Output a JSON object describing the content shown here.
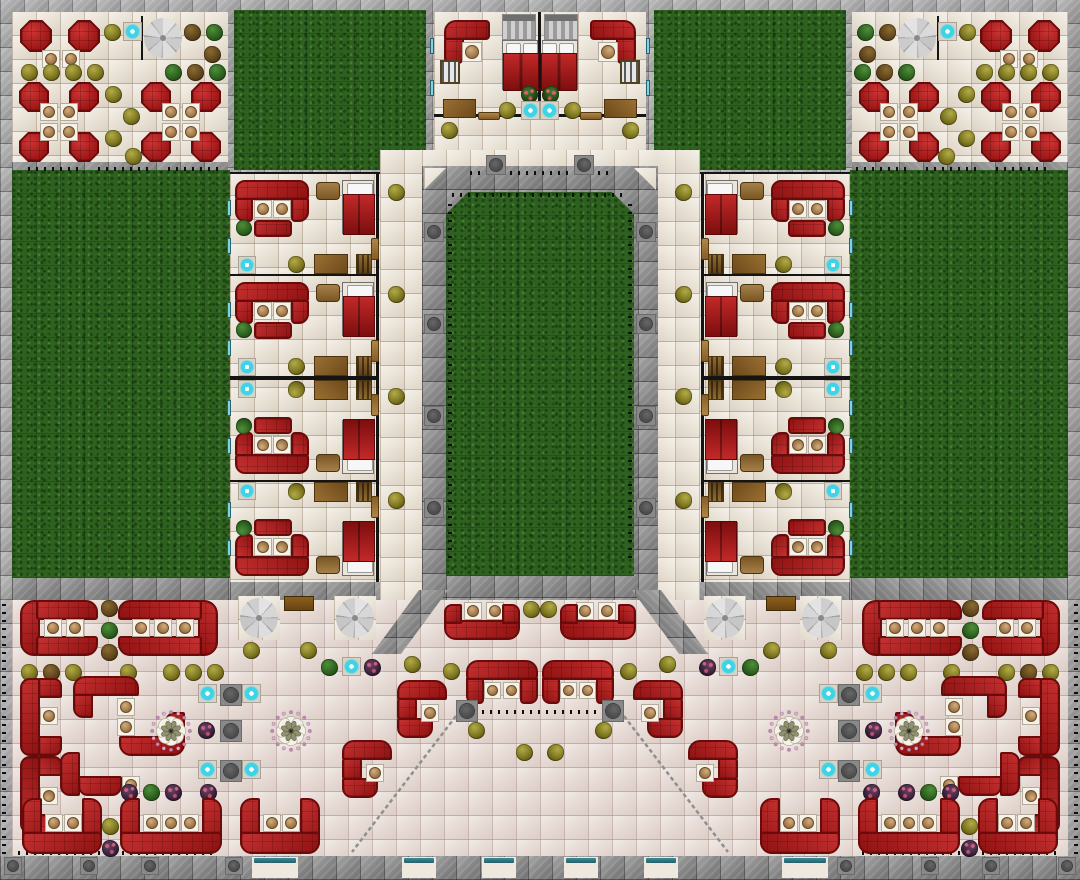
{
  "map": {
    "width": 1080,
    "height": 880,
    "tile": 24,
    "colors": {
      "sofa_red": "#a81c1c",
      "sofa_border": "#6a0b0b",
      "grass_green": "#2e6120",
      "floor_cream": "#eae3d7",
      "hall_floor": "#e7dbd5",
      "wall_gray": "#a4a4a4",
      "wall_dark": "#8d8d8d",
      "water_cyan": "#3cd4e6",
      "wood_brown": "#8a6028",
      "bench_teal": "#2e7682",
      "table_top": "#b08a58"
    },
    "regions": [
      {
        "c": "floor",
        "x": 12,
        "y": 12,
        "w": 216,
        "h": 150,
        "m": 1
      },
      {
        "c": "grass",
        "x": 234,
        "y": 10,
        "w": 192,
        "h": 160,
        "m": 1
      },
      {
        "c": "floor",
        "x": 434,
        "y": 12,
        "w": 212,
        "h": 103,
        "m": 0
      },
      {
        "c": "floor",
        "x": 434,
        "y": 112,
        "w": 212,
        "h": 40,
        "m": 0
      },
      {
        "c": "floor",
        "x": 422,
        "y": 150,
        "w": 236,
        "h": 18,
        "m": 0
      },
      {
        "c": "floor",
        "x": 380,
        "y": 150,
        "w": 42,
        "h": 452,
        "m": 1
      },
      {
        "c": "floor",
        "x": 230,
        "y": 172,
        "w": 150,
        "h": 410,
        "m": 1
      },
      {
        "c": "grass",
        "x": 12,
        "y": 170,
        "w": 218,
        "h": 408,
        "m": 1
      },
      {
        "c": "hall",
        "x": 12,
        "y": 600,
        "w": 1056,
        "h": 256,
        "m": 0
      },
      {
        "c": "walld",
        "x": 422,
        "y": 166,
        "w": 236,
        "h": 434,
        "m": 0
      },
      {
        "c": "walld",
        "x": 12,
        "y": 578,
        "w": 218,
        "h": 22,
        "m": 1
      },
      {
        "c": "walld",
        "x": 230,
        "y": 582,
        "w": 150,
        "h": 18,
        "m": 1
      },
      {
        "c": "walld",
        "x": 12,
        "y": 162,
        "w": 216,
        "h": 8,
        "m": 1
      },
      {
        "c": "walld",
        "x": 0,
        "y": 856,
        "w": 1080,
        "h": 24,
        "m": 0
      },
      {
        "c": "floor",
        "x": 238,
        "y": 596,
        "w": 42,
        "h": 44,
        "m": 1
      },
      {
        "c": "floor",
        "x": 334,
        "y": 596,
        "w": 42,
        "h": 44,
        "m": 1
      },
      {
        "c": "court",
        "x": 446,
        "y": 192,
        "w": 188,
        "h": 384,
        "m": 0
      },
      {
        "c": "ftril",
        "x": 424,
        "y": 168,
        "w": 22,
        "h": 22,
        "m": 0
      },
      {
        "c": "ftrir",
        "x": 634,
        "y": 168,
        "w": 22,
        "h": 22,
        "m": 0
      },
      {
        "c": "wedge",
        "x": 372,
        "y": 590,
        "w": 76,
        "h": 64,
        "m": 1
      }
    ],
    "walls": [
      {
        "x": 141,
        "y": 16,
        "w": 2,
        "h": 44,
        "m": 1
      },
      {
        "x": 538,
        "y": 12,
        "w": 3,
        "h": 104,
        "m": 0
      },
      {
        "x": 434,
        "y": 114,
        "w": 104,
        "h": 3,
        "m": 1
      },
      {
        "x": 230,
        "y": 172,
        "w": 150,
        "h": 2,
        "m": 1
      }
    ],
    "fences": [
      {
        "o": "h",
        "x": 28,
        "y": 167,
        "l": 56,
        "m": 1
      },
      {
        "o": "h",
        "x": 98,
        "y": 167,
        "l": 56,
        "m": 1
      },
      {
        "o": "h",
        "x": 168,
        "y": 167,
        "l": 56,
        "m": 1
      },
      {
        "o": "h",
        "x": 470,
        "y": 171,
        "l": 140,
        "m": 0
      },
      {
        "o": "h",
        "x": 452,
        "y": 193,
        "l": 176,
        "m": 0
      },
      {
        "o": "v",
        "x": 448,
        "y": 198,
        "l": 360,
        "m": 1
      },
      {
        "o": "h",
        "x": 482,
        "y": 710,
        "l": 118,
        "m": 0
      },
      {
        "o": "h",
        "x": 18,
        "y": 851,
        "l": 200,
        "m": 1
      },
      {
        "o": "v",
        "x": 2,
        "y": 604,
        "l": 250,
        "m": 1
      }
    ],
    "railings": [
      {
        "x1": 456,
        "y1": 716,
        "x2": 352,
        "y2": 852,
        "m": 1
      }
    ],
    "room_unit": {
      "w": 150,
      "h": 102,
      "parts": [
        {
          "t": "wallv",
          "x": 146,
          "y": 0,
          "w": 3,
          "h": 102
        },
        {
          "t": "wallh",
          "x": 0,
          "y": 100,
          "w": 147,
          "h": 2
        },
        {
          "t": "sofa",
          "x": 5,
          "y": 6,
          "w": 74,
          "h": 20,
          "r": "10px 10px 3px 3px"
        },
        {
          "t": "sofa",
          "x": 5,
          "y": 24,
          "w": 18,
          "h": 24,
          "r": "2px 0 4px 10px"
        },
        {
          "t": "sofa",
          "x": 61,
          "y": 24,
          "w": 18,
          "h": 24,
          "r": "0 2px 10px 4px"
        },
        {
          "t": "table",
          "x": 24,
          "y": 26,
          "s": 18
        },
        {
          "t": "table",
          "x": 43,
          "y": 26,
          "s": 18
        },
        {
          "t": "sofa",
          "x": 24,
          "y": 46,
          "w": 38,
          "h": 17,
          "r": "4px"
        },
        {
          "t": "plant",
          "v": "green",
          "x": 6,
          "y": 46,
          "s": 16
        },
        {
          "t": "window",
          "x": -3,
          "y": 26,
          "w": 4,
          "h": 16
        },
        {
          "t": "window",
          "x": -3,
          "y": 64,
          "w": 4,
          "h": 16
        },
        {
          "t": "nightstand",
          "x": 86,
          "y": 8,
          "w": 24,
          "h": 18
        },
        {
          "t": "bed1",
          "x": 112,
          "y": 6
        },
        {
          "t": "fountain",
          "x": 8,
          "y": 82,
          "s": 18
        },
        {
          "t": "plant",
          "v": "olive",
          "x": 58,
          "y": 82,
          "s": 17
        },
        {
          "t": "desk",
          "x": 84,
          "y": 80,
          "w": 34,
          "h": 20
        },
        {
          "t": "dresser",
          "x": 126,
          "y": 80,
          "w": 16,
          "h": 20
        },
        {
          "t": "doorv",
          "x": 141,
          "y": 64,
          "w": 8,
          "h": 22
        }
      ]
    },
    "room_units": [
      {
        "x": 230,
        "y": 174,
        "m": 1
      },
      {
        "x": 230,
        "y": 276,
        "m": 1
      },
      {
        "x": 230,
        "y": 378,
        "g": 1,
        "m": 1
      },
      {
        "x": 230,
        "y": 480,
        "g": 1,
        "m": 1
      }
    ],
    "items": [
      {
        "t": "duo",
        "x": 20,
        "y": 20,
        "m": 1
      },
      {
        "t": "plant",
        "v": "olive",
        "x": 104,
        "y": 24,
        "m": 1
      },
      {
        "t": "fountain",
        "x": 123,
        "y": 22,
        "m": 1
      },
      {
        "t": "spiral",
        "x": 144,
        "y": 18,
        "m": 1
      },
      {
        "t": "plant",
        "v": "brown",
        "x": 184,
        "y": 24,
        "m": 1
      },
      {
        "t": "plant",
        "v": "green",
        "x": 206,
        "y": 24,
        "m": 1
      },
      {
        "t": "plant",
        "v": "brown",
        "x": 204,
        "y": 46,
        "m": 1
      },
      {
        "t": "plant",
        "v": "olive",
        "x": 21,
        "y": 64,
        "m": 1
      },
      {
        "t": "plant",
        "v": "olive",
        "x": 43,
        "y": 64,
        "m": 1
      },
      {
        "t": "plant",
        "v": "olive",
        "x": 65,
        "y": 64,
        "m": 1
      },
      {
        "t": "plant",
        "v": "olive",
        "x": 87,
        "y": 64,
        "m": 1
      },
      {
        "t": "plant",
        "v": "green",
        "x": 165,
        "y": 64,
        "m": 1
      },
      {
        "t": "plant",
        "v": "brown",
        "x": 187,
        "y": 64,
        "m": 1
      },
      {
        "t": "plant",
        "v": "green",
        "x": 209,
        "y": 64,
        "m": 1
      },
      {
        "t": "plant",
        "v": "olive",
        "x": 105,
        "y": 86,
        "m": 1
      },
      {
        "t": "plant",
        "v": "olive",
        "x": 123,
        "y": 108,
        "m": 1
      },
      {
        "t": "plant",
        "v": "olive",
        "x": 105,
        "y": 130,
        "m": 1
      },
      {
        "t": "plant",
        "v": "olive",
        "x": 125,
        "y": 148,
        "m": 1
      },
      {
        "t": "quad",
        "x": 19,
        "y": 82,
        "m": 1
      },
      {
        "t": "quad",
        "x": 141,
        "y": 82,
        "m": 1
      },
      {
        "t": "stairs",
        "x": 502,
        "y": 14,
        "m": 1
      },
      {
        "t": "cornerL",
        "x": 444,
        "y": 20,
        "m": 1
      },
      {
        "t": "table",
        "x": 462,
        "y": 42,
        "s": 20,
        "m": 1
      },
      {
        "t": "bookshelf",
        "x": 440,
        "y": 60,
        "w": 20,
        "h": 24,
        "m": 1
      },
      {
        "t": "window",
        "x": 430,
        "y": 38,
        "w": 4,
        "h": 16,
        "m": 1
      },
      {
        "t": "window",
        "x": 430,
        "y": 80,
        "w": 4,
        "h": 16,
        "m": 1
      },
      {
        "t": "bed2",
        "x": 502,
        "y": 40,
        "m": 1
      },
      {
        "t": "plant",
        "v": "flower",
        "x": 521,
        "y": 86,
        "m": 1
      },
      {
        "t": "plant",
        "v": "olive",
        "x": 499,
        "y": 102,
        "m": 1
      },
      {
        "t": "fountain",
        "x": 521,
        "y": 101,
        "m": 1
      },
      {
        "t": "desk",
        "x": 443,
        "y": 99,
        "w": 33,
        "h": 19,
        "m": 1
      },
      {
        "t": "doorh",
        "x": 478,
        "y": 112,
        "w": 22,
        "h": 8,
        "m": 1
      },
      {
        "t": "plant",
        "v": "olive",
        "x": 441,
        "y": 122,
        "m": 1
      },
      {
        "t": "pillar",
        "x": 486,
        "y": 155,
        "s": 20,
        "m": 1
      },
      {
        "t": "pillar",
        "x": 424,
        "y": 222,
        "s": 20,
        "m": 1
      },
      {
        "t": "pillar",
        "x": 424,
        "y": 314,
        "s": 20,
        "m": 1
      },
      {
        "t": "pillar",
        "x": 424,
        "y": 406,
        "s": 20,
        "m": 1
      },
      {
        "t": "pillar",
        "x": 424,
        "y": 498,
        "s": 20,
        "m": 1
      },
      {
        "t": "plant",
        "v": "olive",
        "x": 388,
        "y": 184,
        "m": 1
      },
      {
        "t": "plant",
        "v": "olive",
        "x": 388,
        "y": 286,
        "m": 1
      },
      {
        "t": "plant",
        "v": "olive",
        "x": 388,
        "y": 388,
        "m": 1
      },
      {
        "t": "plant",
        "v": "olive",
        "x": 388,
        "y": 492,
        "m": 1
      },
      {
        "t": "gbooth",
        "n": 2,
        "x": 20,
        "y": 600,
        "m": 1
      },
      {
        "t": "gbooth",
        "n": 3,
        "x": 118,
        "y": 600,
        "f": 1,
        "m": 1
      },
      {
        "t": "plant",
        "v": "brown",
        "x": 101,
        "y": 600,
        "m": 1
      },
      {
        "t": "plant",
        "v": "green",
        "x": 101,
        "y": 622,
        "m": 1
      },
      {
        "t": "plant",
        "v": "brown",
        "x": 101,
        "y": 644,
        "m": 1
      },
      {
        "t": "plant",
        "v": "olive",
        "x": 21,
        "y": 664,
        "m": 1
      },
      {
        "t": "plant",
        "v": "brown",
        "x": 43,
        "y": 664,
        "m": 1
      },
      {
        "t": "plant",
        "v": "olive",
        "x": 65,
        "y": 664,
        "m": 1
      },
      {
        "t": "plant",
        "v": "olive",
        "x": 120,
        "y": 664,
        "m": 1
      },
      {
        "t": "plant",
        "v": "olive",
        "x": 163,
        "y": 664,
        "m": 1
      },
      {
        "t": "plant",
        "v": "olive",
        "x": 185,
        "y": 664,
        "m": 1
      },
      {
        "t": "plant",
        "v": "olive",
        "x": 207,
        "y": 664,
        "m": 1
      },
      {
        "t": "spiral",
        "x": 240,
        "y": 598,
        "m": 1
      },
      {
        "t": "spiral",
        "x": 336,
        "y": 598,
        "m": 1
      },
      {
        "t": "counter",
        "x": 284,
        "y": 596,
        "w": 30,
        "h": 15,
        "m": 1
      },
      {
        "t": "plant",
        "v": "olive",
        "x": 243,
        "y": 642,
        "m": 1
      },
      {
        "t": "plant",
        "v": "olive",
        "x": 300,
        "y": 642,
        "m": 1
      },
      {
        "t": "plant",
        "v": "green",
        "x": 321,
        "y": 659,
        "m": 1
      },
      {
        "t": "fountain",
        "x": 342,
        "y": 657,
        "m": 1
      },
      {
        "t": "plant",
        "v": "purple",
        "x": 364,
        "y": 659,
        "m": 1
      },
      {
        "t": "plant",
        "v": "olive",
        "x": 404,
        "y": 656,
        "m": 1
      },
      {
        "t": "plant",
        "v": "olive",
        "x": 443,
        "y": 663,
        "m": 1
      },
      {
        "t": "wallc",
        "x": 20,
        "y": 678,
        "m": 1
      },
      {
        "t": "wallc",
        "x": 20,
        "y": 756,
        "g": 1,
        "m": 1
      },
      {
        "t": "sbooth",
        "x": 73,
        "y": 676,
        "m": 1
      },
      {
        "t": "lbooth",
        "x": 60,
        "y": 752,
        "m": 1
      },
      {
        "t": "ornate",
        "x": 150,
        "y": 710,
        "m": 1
      },
      {
        "t": "ornate",
        "x": 270,
        "y": 710,
        "m": 1
      },
      {
        "t": "fountain",
        "x": 198,
        "y": 684,
        "m": 1
      },
      {
        "t": "fountain",
        "x": 242,
        "y": 684,
        "m": 1
      },
      {
        "t": "fountain",
        "x": 198,
        "y": 760,
        "m": 1
      },
      {
        "t": "fountain",
        "x": 242,
        "y": 760,
        "m": 1
      },
      {
        "t": "pillar",
        "x": 220,
        "y": 684,
        "s": 22,
        "m": 1
      },
      {
        "t": "pillar",
        "x": 220,
        "y": 720,
        "s": 22,
        "m": 1
      },
      {
        "t": "pillar",
        "x": 220,
        "y": 760,
        "s": 22,
        "m": 1
      },
      {
        "t": "plant",
        "v": "purple",
        "x": 198,
        "y": 722,
        "m": 1
      },
      {
        "t": "plant",
        "v": "purple",
        "x": 121,
        "y": 784,
        "m": 1
      },
      {
        "t": "plant",
        "v": "green",
        "x": 143,
        "y": 784,
        "m": 1
      },
      {
        "t": "plant",
        "v": "purple",
        "x": 165,
        "y": 784,
        "m": 1
      },
      {
        "t": "plant",
        "v": "purple",
        "x": 200,
        "y": 784,
        "m": 1
      },
      {
        "t": "plant",
        "v": "olive",
        "x": 102,
        "y": 818,
        "m": 1
      },
      {
        "t": "plant",
        "v": "purple",
        "x": 102,
        "y": 840,
        "m": 1
      },
      {
        "t": "band",
        "n": 2,
        "x": 22,
        "y": 798,
        "m": 1
      },
      {
        "t": "band",
        "n": 3,
        "x": 120,
        "y": 798,
        "m": 1
      },
      {
        "t": "band",
        "n": 2,
        "x": 240,
        "y": 798,
        "m": 1
      },
      {
        "t": "ubooth",
        "x": 444,
        "y": 600,
        "m": 1
      },
      {
        "t": "plant",
        "v": "olive",
        "x": 523,
        "y": 601,
        "m": 1
      },
      {
        "t": "arch",
        "x": 466,
        "y": 660,
        "m": 1
      },
      {
        "t": "hook",
        "x": 397,
        "y": 680,
        "m": 1
      },
      {
        "t": "hook",
        "x": 342,
        "y": 740,
        "m": 1
      },
      {
        "t": "plant",
        "v": "olive",
        "x": 468,
        "y": 722,
        "m": 1
      },
      {
        "t": "plant",
        "v": "olive",
        "x": 516,
        "y": 744,
        "m": 1
      },
      {
        "t": "pillar",
        "x": 456,
        "y": 700,
        "s": 22,
        "m": 1
      },
      {
        "t": "benchdoor",
        "x": 252,
        "y": 857,
        "w": 46,
        "m": 1
      },
      {
        "t": "benchdoor",
        "x": 402,
        "y": 857,
        "w": 34,
        "m": 1
      },
      {
        "t": "benchdoor",
        "x": 482,
        "y": 857,
        "w": 34,
        "m": 1
      },
      {
        "t": "pillar",
        "x": 4,
        "y": 857,
        "s": 18,
        "m": 1
      },
      {
        "t": "pillar",
        "x": 80,
        "y": 857,
        "s": 18,
        "m": 1
      },
      {
        "t": "pillar",
        "x": 141,
        "y": 857,
        "s": 18,
        "m": 1
      },
      {
        "t": "pillar",
        "x": 225,
        "y": 857,
        "s": 18,
        "m": 1
      }
    ]
  }
}
